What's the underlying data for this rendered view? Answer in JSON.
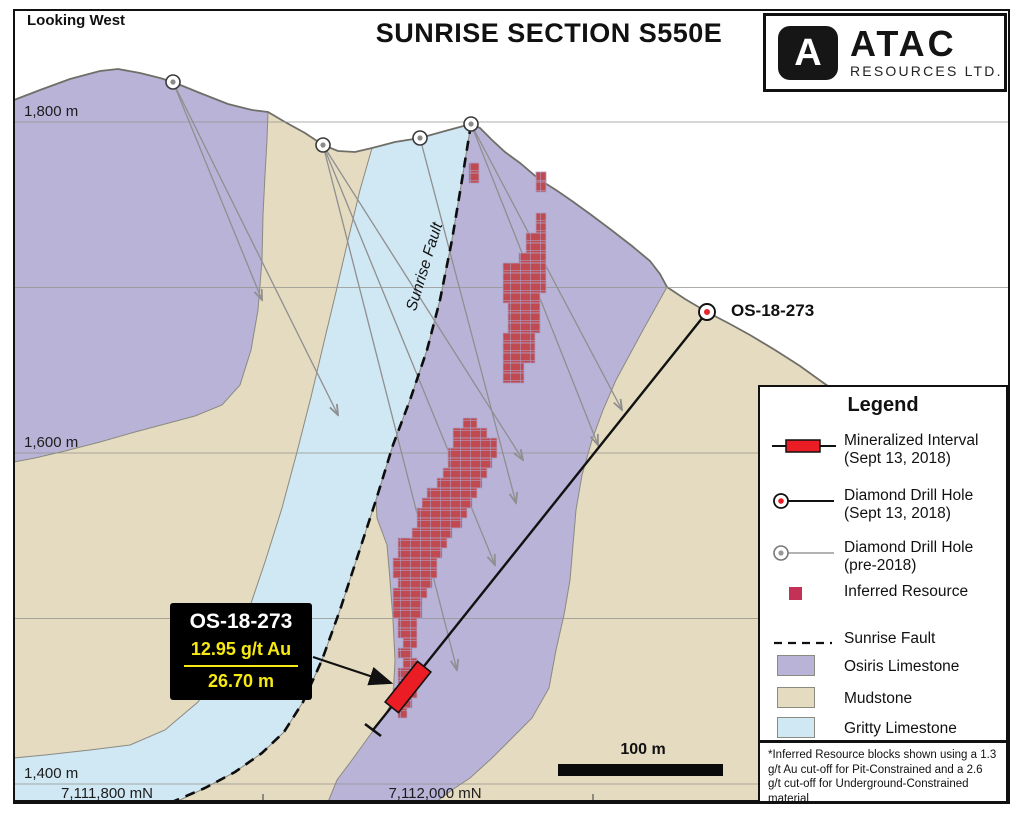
{
  "header": {
    "view_label": "Looking West",
    "title": "SUNRISE SECTION S550E"
  },
  "logo": {
    "letter": "A",
    "name": "ATAC",
    "subtitle": "RESOURCES LTD."
  },
  "axes": {
    "elevation_labels": [
      {
        "text": "1,800 m",
        "y": 122
      },
      {
        "text": "1,600 m",
        "y": 453
      },
      {
        "text": "1,400 m",
        "y": 784
      }
    ],
    "gridline_ys": [
      122,
      287.5,
      453,
      618.5,
      784
    ],
    "northing_labels": [
      {
        "text": "7,111,800 mN",
        "x": 107
      },
      {
        "text": "7,112,000 mN",
        "x": 435
      }
    ],
    "tick_xs": [
      263,
      593
    ]
  },
  "scalebar": {
    "label": "100 m"
  },
  "fault_label": "Sunrise Fault",
  "collar_label": "OS-18-273",
  "annotation": {
    "hole": "OS-18-273",
    "grade": "12.95 g/t Au",
    "interval": "26.70 m"
  },
  "legend": {
    "title": "Legend",
    "items": [
      {
        "label": "Mineralized Interval",
        "label2": "(Sept 13, 2018)"
      },
      {
        "label": "Diamond Drill Hole",
        "label2": "(Sept 13, 2018)"
      },
      {
        "label": "Diamond Drill Hole",
        "label2": "(pre-2018)"
      },
      {
        "label": "Inferred Resource"
      },
      {
        "label": "Sunrise Fault"
      },
      {
        "label": "Osiris Limestone"
      },
      {
        "label": "Mudstone"
      },
      {
        "label": "Gritty Limestone"
      }
    ],
    "footnote": "*Inferred Resource blocks shown using a 1.3 g/t Au cut-off for Pit-Constrained and a 2.6 g/t cut-off for Underground-Constrained material"
  },
  "colors": {
    "osiris": "#b9b3d8",
    "mudstone": "#e4dbc0",
    "gritty": "#d0e7f4",
    "resource_block": "#c04a50",
    "resource_legend": "#c43157",
    "mineralized": "#ea1c24",
    "annotation_accent": "#f6e912"
  },
  "geology": {
    "terrain_fill": "14,100 40,90 70,79 100,71 118,69 140,73 160,78 173,82 200,93 228,104 252,110 268,112 285,122 305,133 323,145 338,151 355,152 372,148 395,142 420,138 445,131 471,124 480,128 492,140 505,152 520,163 540,180 556,190 572,201 590,214 610,229 632,246 650,261 660,274 667,287 685,299 707,312 730,324 750,335 775,350 800,366 825,384 855,403 890,420 950,445 1009,462 1009,802 14,802",
    "terrain_line": "14,100 40,90 70,79 100,71 118,69 140,73 160,78 173,82 200,93 228,104 252,110 268,112 285,122 305,133 323,145 338,151 355,152 372,148 395,142 420,138 445,131 471,124 480,128 492,140 505,152 520,163 540,180 556,190 572,201 590,214 610,229 632,246 650,261 660,274 667,287 685,299 707,312 730,324 750,335 775,350 800,366 825,384 855,403 890,420 950,445 1009,462",
    "purple_left": "14,100 40,90 70,79 100,71 118,69 140,73 160,78 173,82 200,93 228,104 252,110 268,112 267,140 265,175 263,215 262,260 258,310 251,350 240,385 222,405 195,416 165,424 135,432 100,442 65,451 35,458 14,462",
    "blue_band": "372,148 395,142 420,138 445,131 471,124 462,180 452,240 440,300 427,350 410,400 393,445 376,500 358,555 340,610 322,660 303,702 284,732 262,753 235,772 205,788 178,801 172,802 14,802 14,758 45,755 90,750 130,745 165,730 198,702 224,664 246,618 265,562 282,508 297,452 311,397 324,342 336,292 348,240 360,190",
    "purple_center": "471,124 480,128 492,140 505,152 520,163 540,180 556,190 572,201 590,214 610,229 632,246 650,261 660,274 667,287 643,330 616,380 603,410 592,440 582,475 576,510 573,545 570,580 564,615 556,650 549,688 532,718 512,738 492,758 470,778 452,790 436,802 328,802 337,780 352,760 370,735 385,715 393,700 395,660 393,620 390,580 387,545 377,518 376,500 393,445 410,400 427,350 440,300 452,240 462,180",
    "fault_line": "471,124 462,180 452,240 440,300 427,350 410,400 393,445 376,500 358,555 340,610 322,660 303,702 284,732 262,753 235,772 205,788 172,802"
  },
  "drill": {
    "main_hole_line": "707,312 373,730",
    "main_collar": [
      707,
      312
    ],
    "end_tick": [
      365,
      724,
      381,
      736
    ],
    "interval_center": [
      408,
      687
    ],
    "interval_angle": 128.6,
    "pre_collars": [
      [
        173,
        82
      ],
      [
        323,
        145
      ],
      [
        420,
        138
      ],
      [
        471,
        124
      ]
    ],
    "pre_traces": [
      [
        173,
        82,
        338,
        415
      ],
      [
        173,
        82,
        262,
        300
      ],
      [
        323,
        145,
        457,
        670
      ],
      [
        323,
        145,
        495,
        565
      ],
      [
        323,
        145,
        523,
        460
      ],
      [
        420,
        138,
        516,
        503
      ],
      [
        471,
        124,
        622,
        410
      ],
      [
        471,
        124,
        598,
        445
      ]
    ],
    "callout_arrow": "313,657 391,683"
  },
  "resource_blocks": {
    "cell": 10,
    "upper": [
      [
        469,
        479,
        163
      ],
      [
        469,
        479,
        173
      ],
      [
        536,
        546,
        172
      ],
      [
        536,
        546,
        182
      ],
      [
        536,
        546,
        213
      ],
      [
        536,
        546,
        223
      ],
      [
        526,
        546,
        233
      ],
      [
        526,
        546,
        243
      ],
      [
        519,
        546,
        253
      ],
      [
        503,
        546,
        263
      ],
      [
        503,
        546,
        273
      ],
      [
        503,
        546,
        283
      ],
      [
        503,
        540,
        293
      ],
      [
        508,
        540,
        303
      ],
      [
        508,
        540,
        313
      ],
      [
        508,
        540,
        323
      ],
      [
        503,
        535,
        333
      ],
      [
        503,
        535,
        343
      ],
      [
        503,
        535,
        353
      ],
      [
        503,
        524,
        363
      ],
      [
        503,
        524,
        373
      ]
    ],
    "lower": [
      [
        463,
        477,
        418
      ],
      [
        453,
        487,
        428
      ],
      [
        453,
        497,
        438
      ],
      [
        448,
        497,
        448
      ],
      [
        448,
        492,
        458
      ],
      [
        443,
        487,
        468
      ],
      [
        437,
        482,
        478
      ],
      [
        427,
        477,
        488
      ],
      [
        422,
        472,
        498
      ],
      [
        417,
        467,
        508
      ],
      [
        417,
        462,
        518
      ],
      [
        412,
        452,
        528
      ],
      [
        398,
        447,
        538
      ],
      [
        398,
        442,
        548
      ],
      [
        393,
        437,
        558
      ],
      [
        393,
        437,
        568
      ],
      [
        398,
        432,
        578
      ],
      [
        393,
        427,
        588
      ],
      [
        393,
        422,
        598
      ],
      [
        393,
        422,
        608
      ],
      [
        398,
        417,
        618
      ],
      [
        398,
        417,
        628
      ],
      [
        403,
        417,
        638
      ],
      [
        398,
        412,
        648
      ],
      [
        403,
        417,
        658
      ],
      [
        398,
        412,
        668
      ],
      [
        398,
        412,
        678
      ],
      [
        393,
        417,
        688
      ],
      [
        398,
        412,
        698
      ],
      [
        398,
        407,
        708
      ]
    ]
  }
}
